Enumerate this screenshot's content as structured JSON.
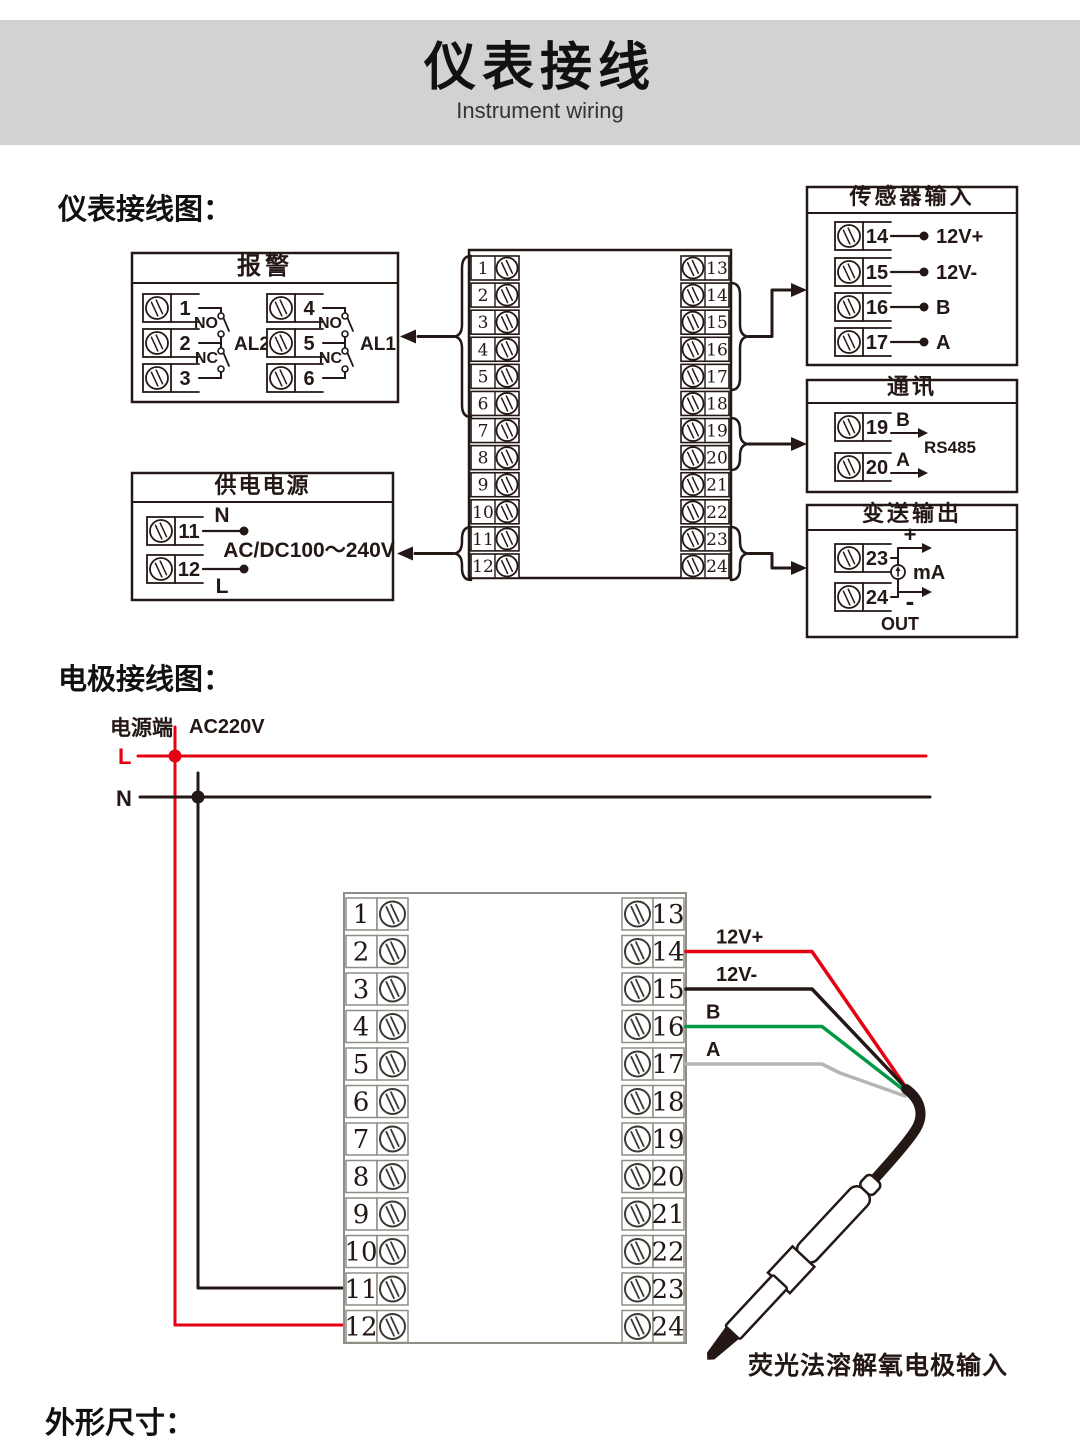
{
  "banner": {
    "title": "仪表接线",
    "subtitle": "Instrument wiring"
  },
  "section_instrument": {
    "heading": "仪表接线图："
  },
  "section_electrode": {
    "heading": "电极接线图："
  },
  "section_dimensions": {
    "heading": "外形尺寸："
  },
  "instrument_diagram": {
    "alarm_box": {
      "title": "报警",
      "groups": [
        {
          "label": "AL2",
          "no": "NO",
          "nc": "NC",
          "terminals": [
            "1",
            "2",
            "3"
          ]
        },
        {
          "label": "AL1",
          "no": "NO",
          "nc": "NC",
          "terminals": [
            "4",
            "5",
            "6"
          ]
        }
      ]
    },
    "power_box": {
      "title": "供电电源",
      "rows": [
        {
          "terminal": "11",
          "label": "N"
        },
        {
          "terminal": "12",
          "label": "L"
        }
      ],
      "voltage": "AC/DC100～240V"
    },
    "terminal_block": {
      "left": [
        "1",
        "2",
        "3",
        "4",
        "5",
        "6",
        "7",
        "8",
        "9",
        "10",
        "11",
        "12"
      ],
      "right": [
        "13",
        "14",
        "15",
        "16",
        "17",
        "18",
        "19",
        "20",
        "21",
        "22",
        "23",
        "24"
      ]
    },
    "sensor_box": {
      "title": "传感器输入",
      "rows": [
        {
          "terminal": "14",
          "label": "12V+"
        },
        {
          "terminal": "15",
          "label": "12V-"
        },
        {
          "terminal": "16",
          "label": "B"
        },
        {
          "terminal": "17",
          "label": "A"
        }
      ]
    },
    "comm_box": {
      "title": "通讯",
      "rows": [
        {
          "terminal": "19",
          "label": "B"
        },
        {
          "terminal": "20",
          "label": "A"
        }
      ],
      "bus_label": "RS485"
    },
    "output_box": {
      "title": "变送输出",
      "rows": [
        {
          "terminal": "23"
        },
        {
          "terminal": "24"
        }
      ],
      "plus": "+",
      "minus": "-",
      "unit": "mA",
      "out_label": "OUT"
    }
  },
  "electrode_diagram": {
    "power_terminal_label": "电源端",
    "voltage": "AC220V",
    "live_label": "L",
    "neutral_label": "N",
    "terminal_block": {
      "left": [
        "1",
        "2",
        "3",
        "4",
        "5",
        "6",
        "7",
        "8",
        "9",
        "10",
        "11",
        "12"
      ],
      "right": [
        "13",
        "14",
        "15",
        "16",
        "17",
        "18",
        "19",
        "20",
        "21",
        "22",
        "23",
        "24"
      ]
    },
    "wires": [
      {
        "terminal": "14",
        "label": "12V+",
        "color": "#e60012"
      },
      {
        "terminal": "15",
        "label": "12V-",
        "color": "#231815"
      },
      {
        "terminal": "16",
        "label": "B",
        "color": "#009944"
      },
      {
        "terminal": "17",
        "label": "A",
        "color": "#b5b5b5"
      }
    ],
    "probe_label": "荧光法溶解氧电极输入"
  },
  "colors": {
    "ink": "#231815",
    "banner_bg": "#d2d2d2",
    "live_red": "#e60012",
    "wire_green": "#009944",
    "wire_gray": "#b5b5b5",
    "block_gray": "#8e8e86"
  }
}
